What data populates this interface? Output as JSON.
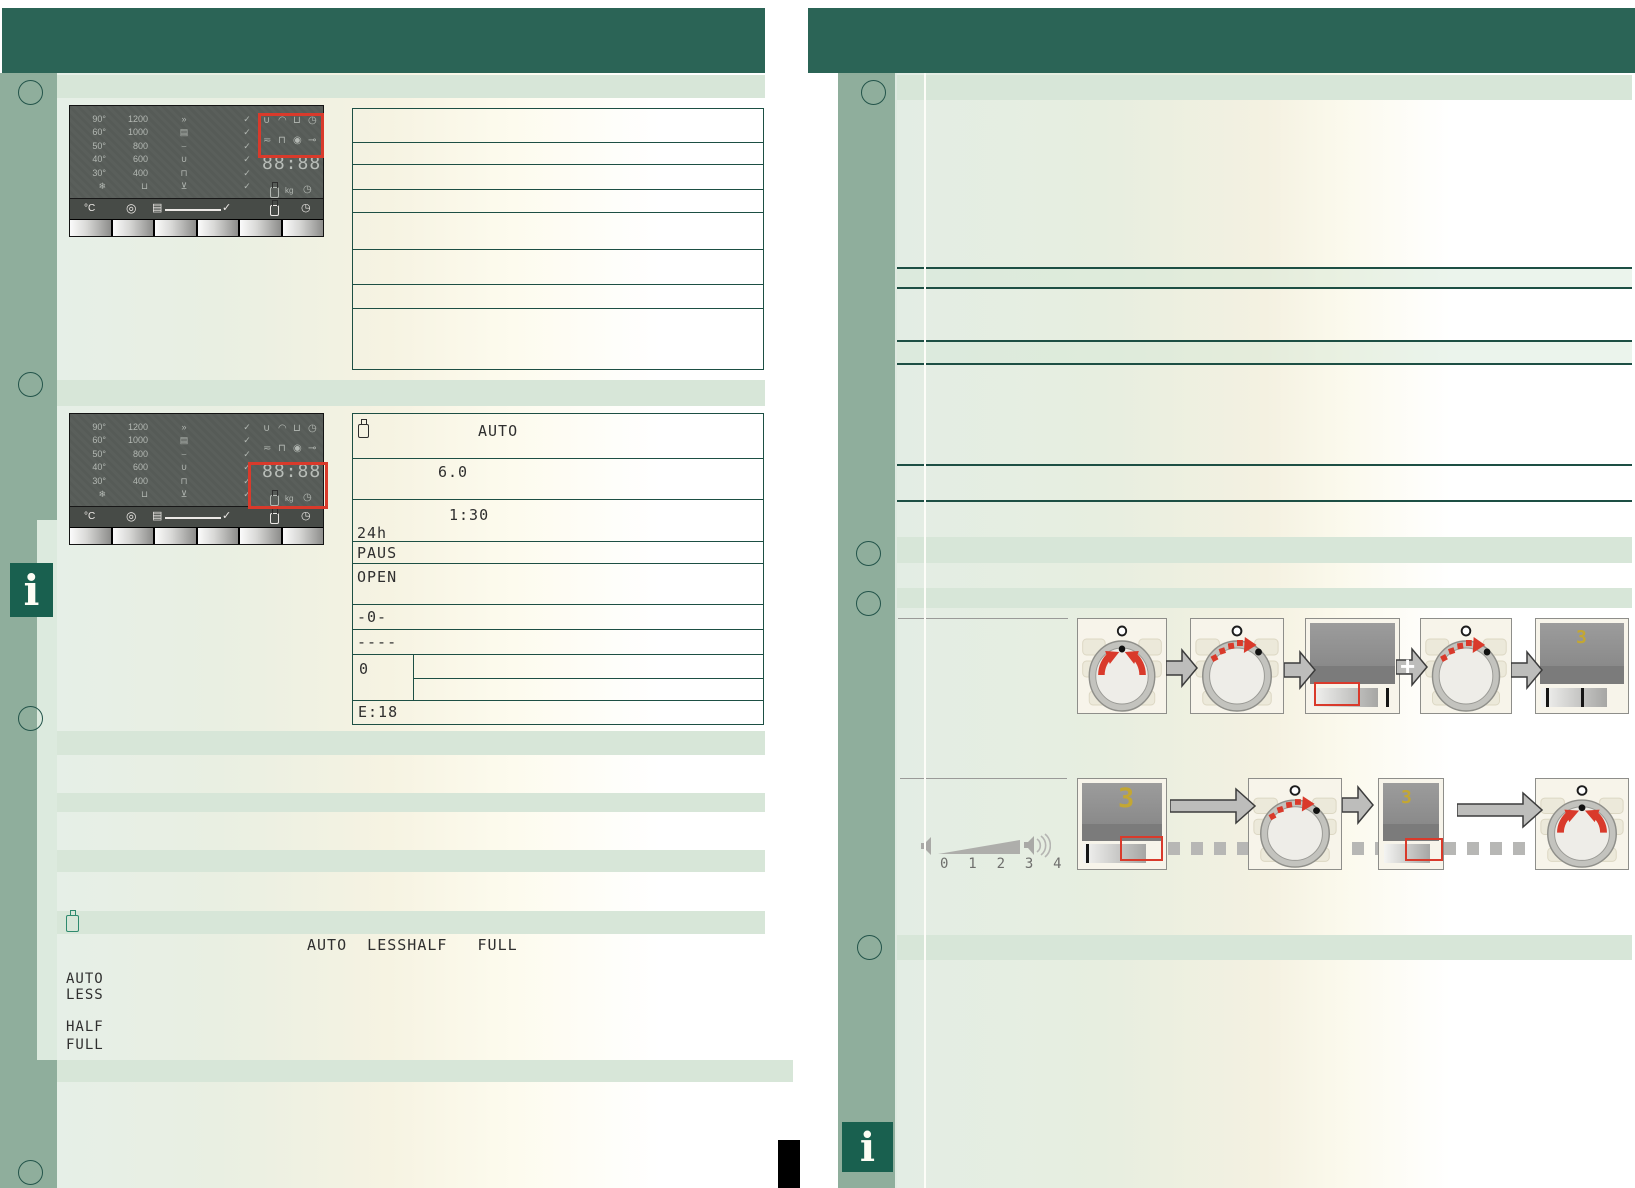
{
  "colors": {
    "header_teal": "#2b6456",
    "sage_green": "#8fae9c",
    "band_green": "#d7e6d8",
    "accent_red": "#d93a2b",
    "display_yellow": "#c3a733",
    "rule_teal": "#1d4f44"
  },
  "left_page": {
    "panel": {
      "temperatures": [
        "90°",
        "60°",
        "50°",
        "40°",
        "30°"
      ],
      "temperature_icon": {
        "name": "snowflake-icon",
        "glyph": "❄"
      },
      "spin_speeds": [
        "1200",
        "1000",
        "800",
        "600",
        "400"
      ],
      "spin_icon": {
        "name": "tub-icon",
        "glyph": "⊔"
      },
      "program_icons": [
        {
          "name": "speed-icon",
          "glyph": "»"
        },
        {
          "name": "easy-iron-icon",
          "glyph": "▤"
        },
        {
          "name": "handwash-icon",
          "glyph": "⌣"
        },
        {
          "name": "delicate-icon",
          "glyph": "∪"
        },
        {
          "name": "wool-icon",
          "glyph": "⊓"
        },
        {
          "name": "drain-icon",
          "glyph": "⊻"
        }
      ],
      "checkmark_glyph": "✓",
      "status_icons_row1": [
        {
          "name": "power-icon",
          "glyph": "∪"
        },
        {
          "name": "lid-icon",
          "glyph": "◠"
        },
        {
          "name": "tub-wave-icon",
          "glyph": "⊔"
        },
        {
          "name": "childlock-icon",
          "glyph": "◷"
        }
      ],
      "status_icons_row2": [
        {
          "name": "tap-icon",
          "glyph": "≂"
        },
        {
          "name": "foam-icon",
          "glyph": "⊓"
        },
        {
          "name": "drop-icon",
          "glyph": "◉"
        },
        {
          "name": "key-icon",
          "glyph": "⊸"
        }
      ],
      "display_time": "88:88",
      "detergent_icon": {
        "name": "bottle-icon"
      },
      "unit_kg": "kg",
      "clock_icon": {
        "name": "clock-icon",
        "glyph": "◷"
      },
      "btn_temp": "°C",
      "btn_spin": {
        "name": "spin-button-icon",
        "glyph": "◎"
      },
      "btn_doc": {
        "name": "program-doc-icon",
        "glyph": "▤"
      },
      "btn_check": "✓"
    },
    "table1": {
      "x": 352,
      "top": 108,
      "width": 410,
      "row_lines": [
        141,
        163,
        188,
        211,
        248,
        283,
        307
      ],
      "bottom": 368
    },
    "table2": {
      "x": 352,
      "top": 413,
      "width": 410,
      "bottom": 723,
      "row_lines": [
        457,
        498,
        540,
        562,
        603,
        628,
        653,
        699
      ],
      "split": {
        "vline_x": 60,
        "from_y": 240,
        "to_y": 286,
        "subline_y": 264
      },
      "rows": [
        {
          "value": "AUTO",
          "x": 125,
          "y": 8,
          "has_bottle": true
        },
        {
          "value": "6.0",
          "x": 85,
          "y": 49
        },
        {
          "value": "1:30",
          "x": 96,
          "y": 92
        },
        {
          "value": "24h",
          "x": 4,
          "y": 110
        },
        {
          "value": "PAUS",
          "x": 4,
          "y": 130
        },
        {
          "value": "OPEN",
          "x": 4,
          "y": 154
        },
        {
          "value": "-0-",
          "x": 4,
          "y": 194
        },
        {
          "value": "----",
          "x": 4,
          "y": 219
        },
        {
          "value": "0",
          "x": 6,
          "y": 246
        },
        {
          "value": "E:18",
          "x": 5,
          "y": 289
        }
      ]
    },
    "load_display_line": "AUTO  LESSHALF   FULL",
    "load_labels": [
      "AUTO",
      "LESS",
      "HALF",
      "FULL"
    ]
  },
  "right_page": {
    "volume": {
      "levels": "0  1  2  3  4"
    },
    "display_value": "3"
  }
}
